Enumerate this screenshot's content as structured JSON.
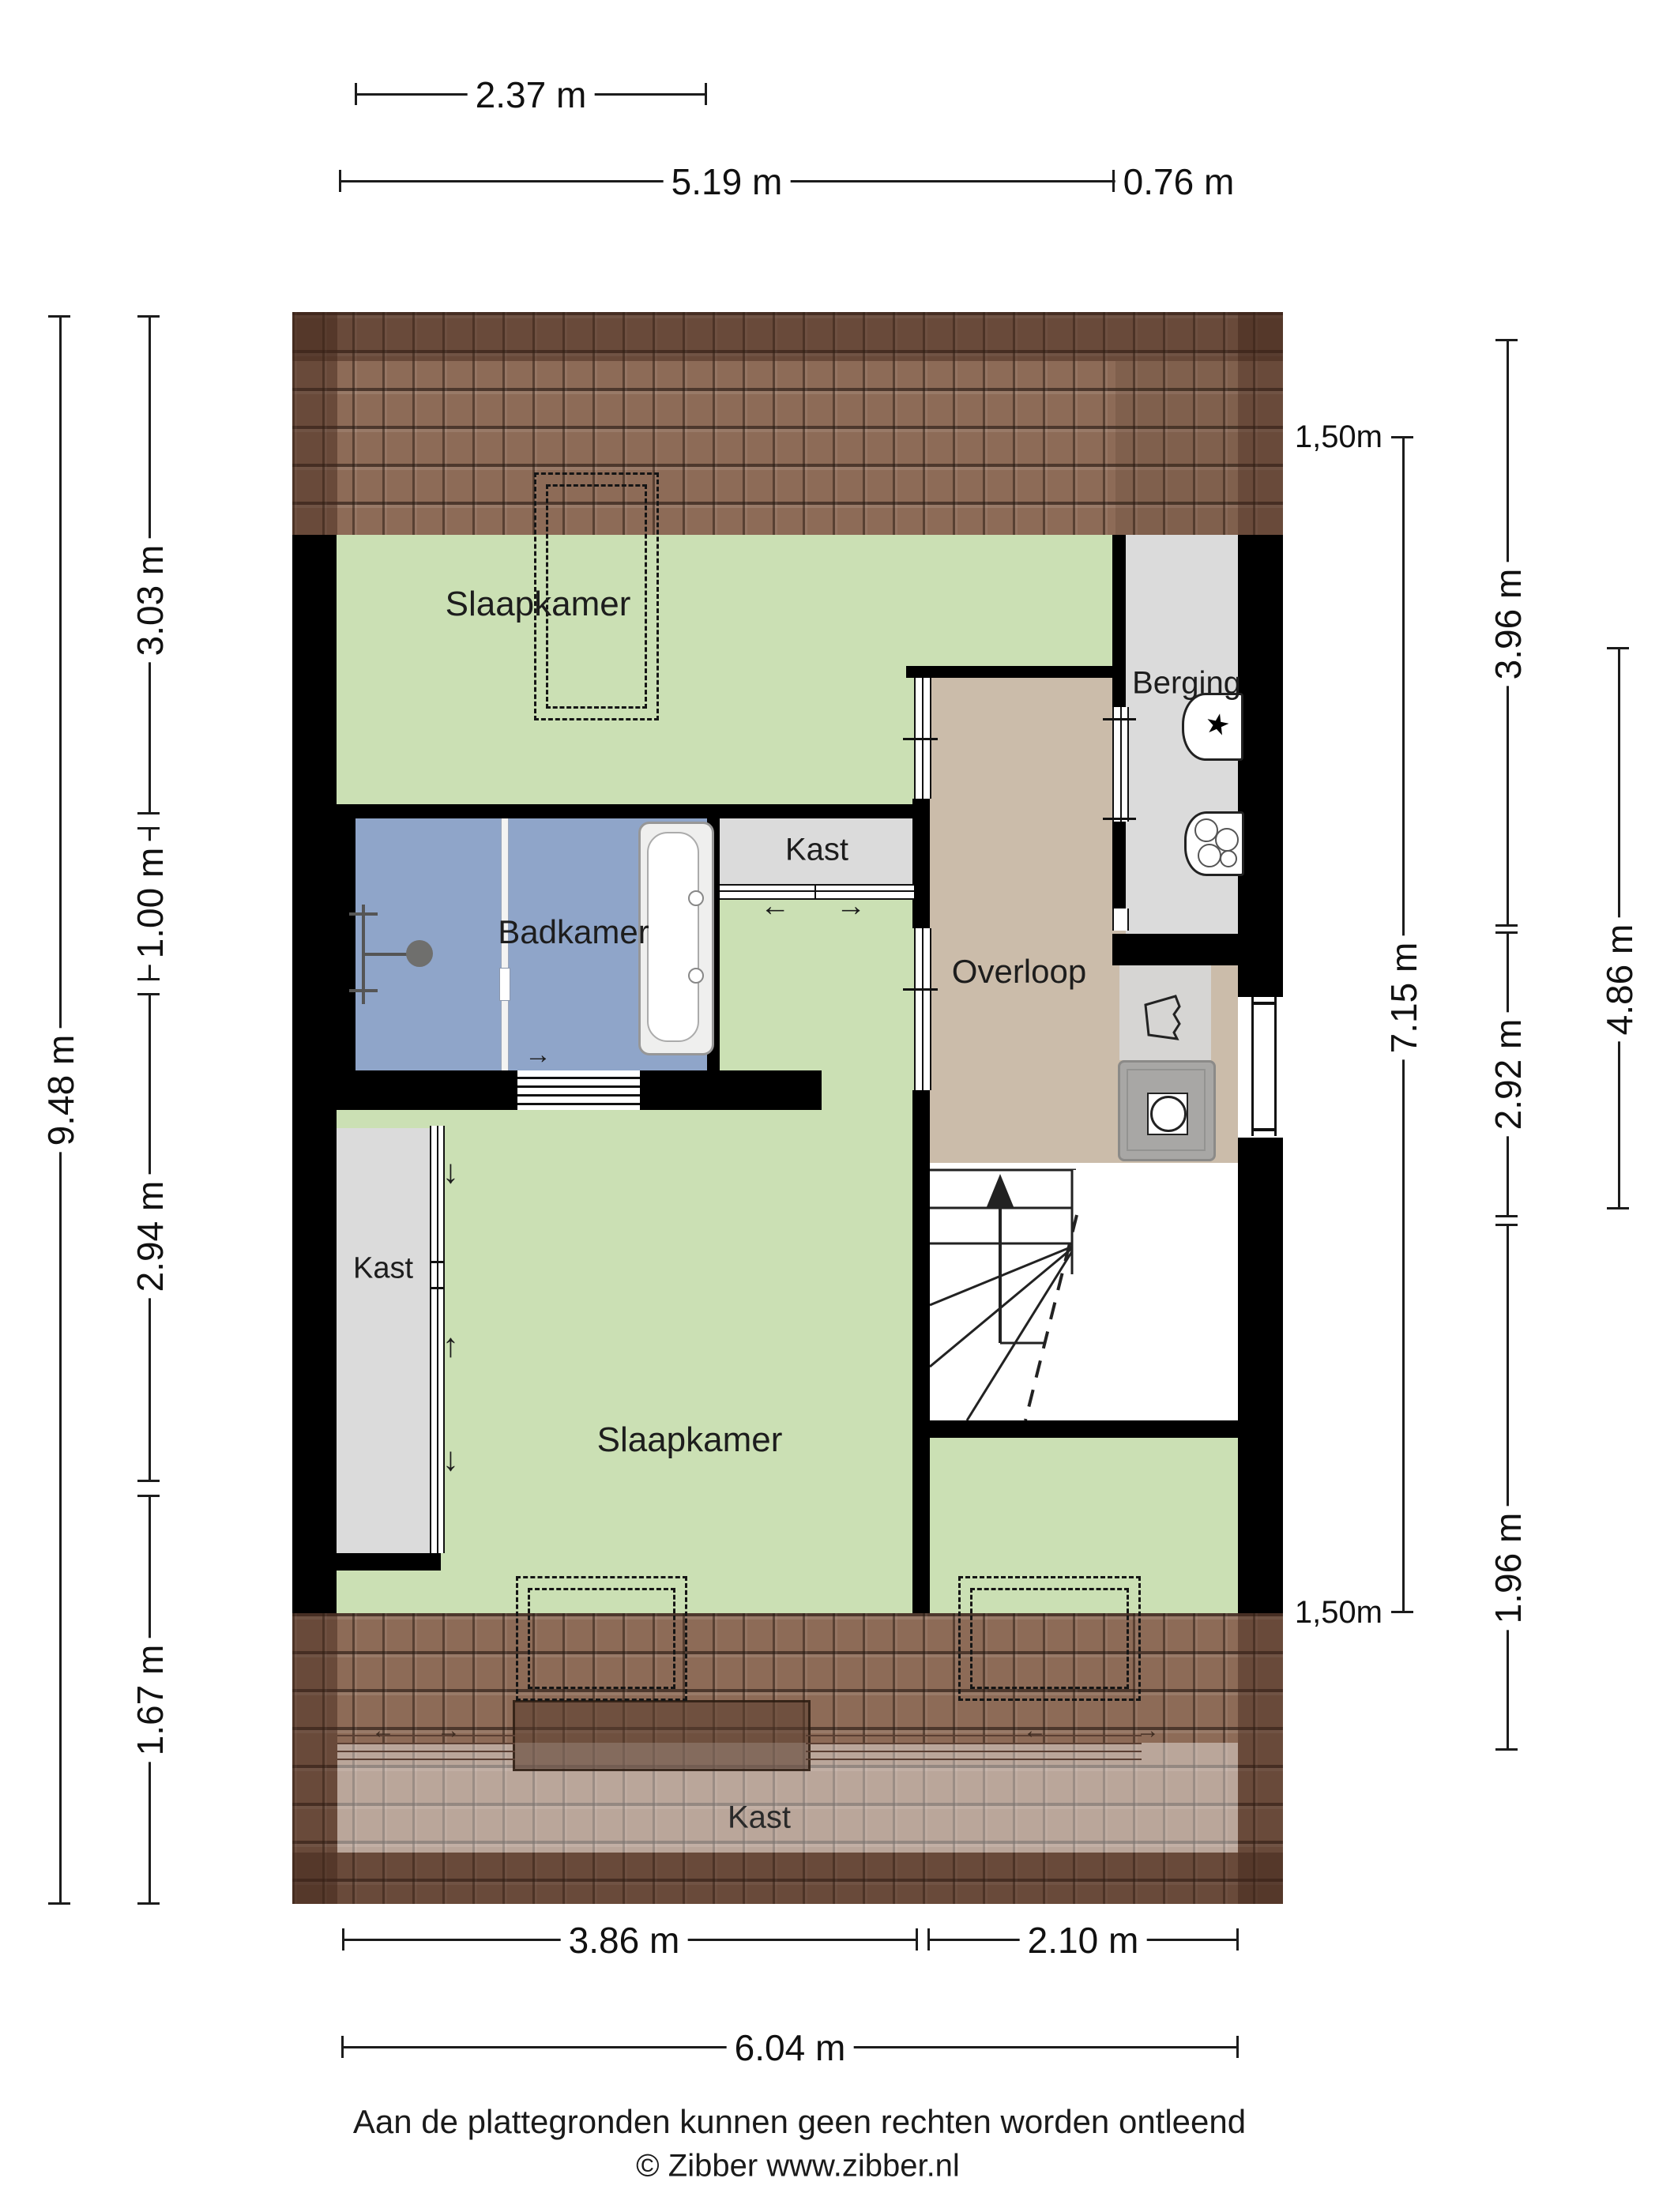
{
  "plan_title": "floor-plan-attic-zibber",
  "rooms": {
    "slaapkamer_top": {
      "label": "Slaapkamer"
    },
    "badkamer": {
      "label": "Badkamer"
    },
    "kast_top": {
      "label": "Kast"
    },
    "berging": {
      "label": "Berging"
    },
    "overloop": {
      "label": "Overloop"
    },
    "kast_left": {
      "label": "Kast"
    },
    "slaapkamer_bottom": {
      "label": "Slaapkamer"
    },
    "kast_bottom": {
      "label": "Kast"
    }
  },
  "dimensions": {
    "top": {
      "d237": "2.37 m",
      "d519": "5.19 m",
      "d076": "0.76 m"
    },
    "bottom": {
      "d386": "3.86 m",
      "d210": "2.10 m",
      "d604": "6.04 m"
    },
    "left": {
      "d948": "9.48 m",
      "d303": "3.03 m",
      "d100": "1.00 m",
      "d294": "2.94 m",
      "d167": "1.67 m"
    },
    "right": {
      "h150_top": "1,50m",
      "d396": "3.96 m",
      "d715": "7.15 m",
      "d292": "2.92 m",
      "d486": "4.86 m",
      "d196": "1.96 m",
      "h150_bottom": "1,50m"
    }
  },
  "footer": {
    "disclaimer": "Aan de plattegronden kunnen geen rechten worden ontleend",
    "copyright": "© Zibber www.zibber.nl"
  },
  "icons": {
    "washing_machine": "★",
    "arrow_left": "←",
    "arrow_right": "→",
    "arrow_up": "↑",
    "arrow_down": "↓"
  },
  "colors": {
    "room_green": "#cbe0b4",
    "bathroom_blue": "#8fa5c9",
    "hallway_tan": "#cbbcaa",
    "closet_gray": "#dbdbdb",
    "roof_brown": "#8d6b57",
    "wall_black": "#000000"
  }
}
